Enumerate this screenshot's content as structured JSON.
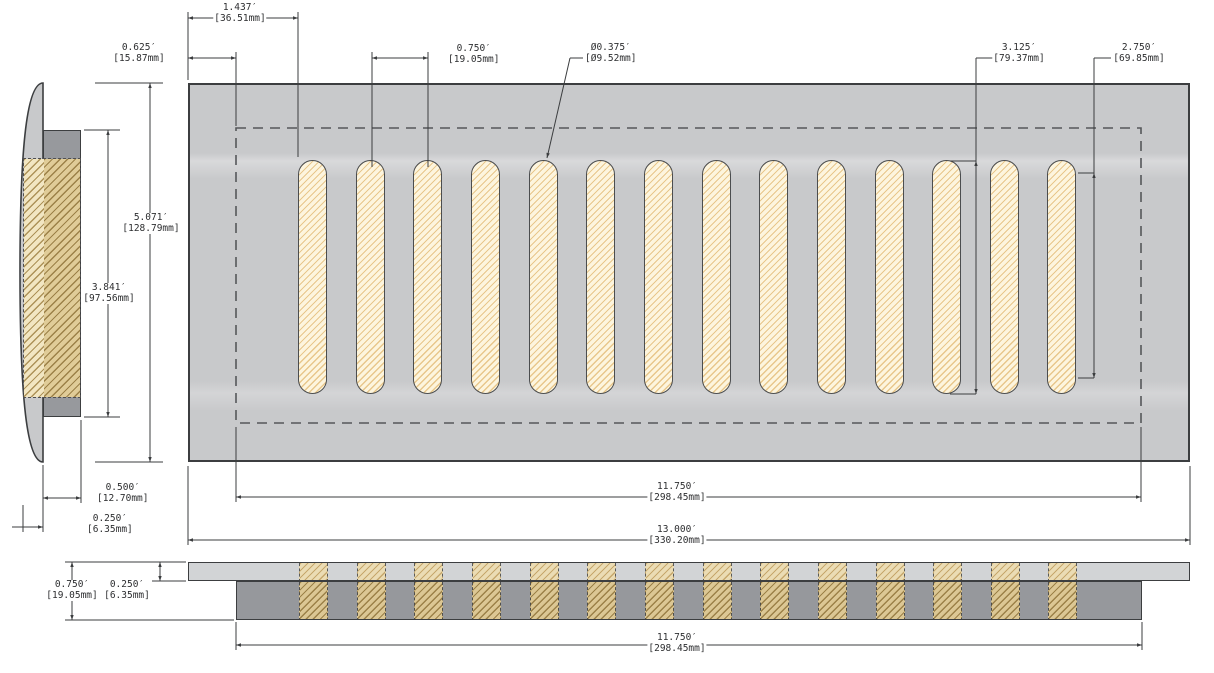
{
  "drawing_type": "vent-register-technical-drawing",
  "units_note": "inches [mm]",
  "dims": {
    "d1437": {
      "in": "1.437′",
      "mm": "[36.51mm]"
    },
    "d0625": {
      "in": "0.625′",
      "mm": "[15.87mm]"
    },
    "d0750_slots": {
      "in": "0.750′",
      "mm": "[19.05mm]"
    },
    "d0375_dia": {
      "in": "Ø0.375′",
      "mm": "[Ø9.52mm]"
    },
    "d3125": {
      "in": "3.125′",
      "mm": "[79.37mm]"
    },
    "d2750": {
      "in": "2.750′",
      "mm": "[69.85mm]"
    },
    "d5071": {
      "in": "5.071′",
      "mm": "[128.79mm]"
    },
    "d3841": {
      "in": "3.841′",
      "mm": "[97.56mm]"
    },
    "d0500": {
      "in": "0.500′",
      "mm": "[12.70mm]"
    },
    "d0250_side": {
      "in": "0.250′",
      "mm": "[6.35mm]"
    },
    "d11750_face": {
      "in": "11.750′",
      "mm": "[298.45mm]"
    },
    "d13000": {
      "in": "13.000′",
      "mm": "[330.20mm]"
    },
    "d0750_bv": {
      "in": "0.750′",
      "mm": "[19.05mm]"
    },
    "d0250_bv": {
      "in": "0.250′",
      "mm": "[6.35mm]"
    },
    "d11750_bv": {
      "in": "11.750′",
      "mm": "[298.45mm]"
    }
  },
  "figure": {
    "slot_count": 14,
    "slot_first_left": 298,
    "slot_pitch": 57.65,
    "slot_width": 29,
    "slot_top": 160,
    "slot_height": 234,
    "strip_top_left": 188,
    "strip_duct_left": 236
  },
  "colors": {
    "plate_gray": "#c8c9cb",
    "duct_gray": "#96989c",
    "slot_fill": "#fdf5de",
    "slot_hatch": "#e8c78c",
    "side_hatch_fill": "#e0cc98",
    "side_hatch_line": "#9c8148",
    "line_color": "#3b3d3f",
    "dashed_color": "#55575a"
  }
}
